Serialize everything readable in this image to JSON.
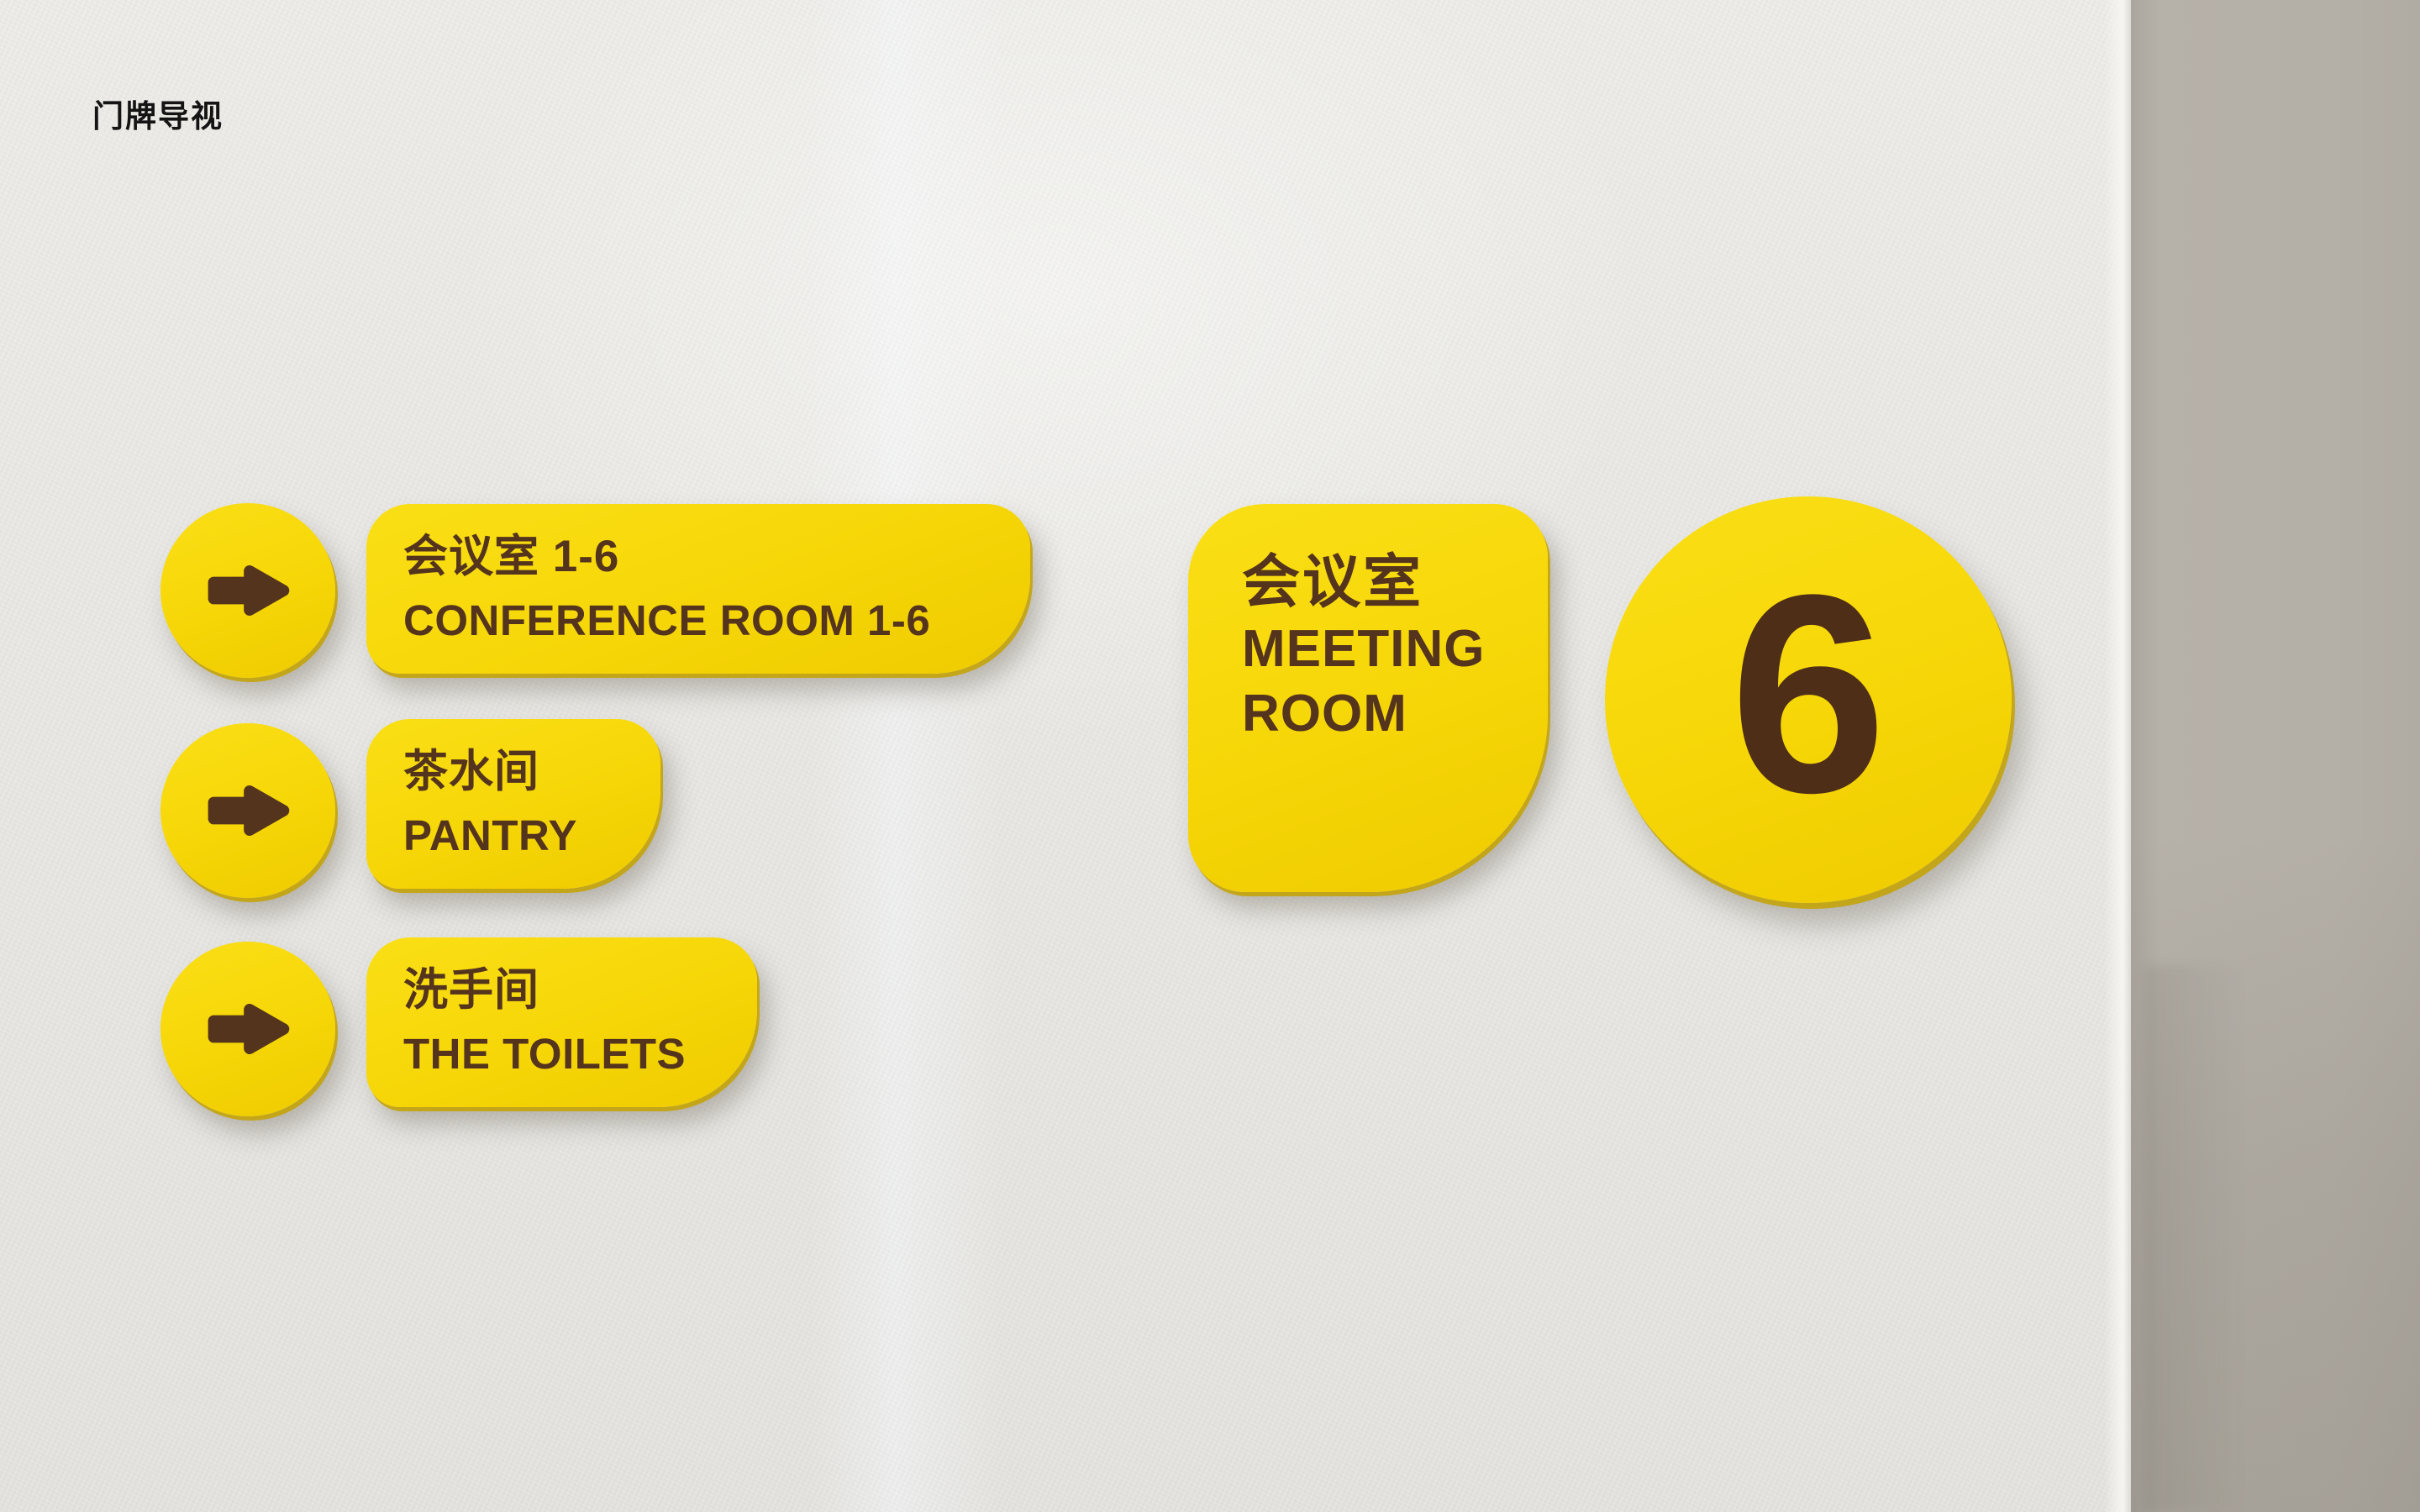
{
  "header": {
    "title": "门牌导视"
  },
  "colors": {
    "wall": "#e9e8e4",
    "wall_side_panel": "#b4afa7",
    "sign_yellow": "#f6d607",
    "sign_edge_yellow": "#c4a200",
    "sign_text_brown": "#54341d",
    "title_black": "#141414"
  },
  "directory": {
    "items": [
      {
        "icon": "arrow-right",
        "zh": "会议室 1-6",
        "en": "CONFERENCE ROOM 1-6"
      },
      {
        "icon": "arrow-right",
        "zh": "茶水间",
        "en": "PANTRY"
      },
      {
        "icon": "arrow-right",
        "zh": "洗手间",
        "en": "THE TOILETS"
      }
    ]
  },
  "room_sign": {
    "zh": "会议室",
    "en_line1": "MEETING",
    "en_line2": "ROOM"
  },
  "number_sign": {
    "value": "6"
  }
}
